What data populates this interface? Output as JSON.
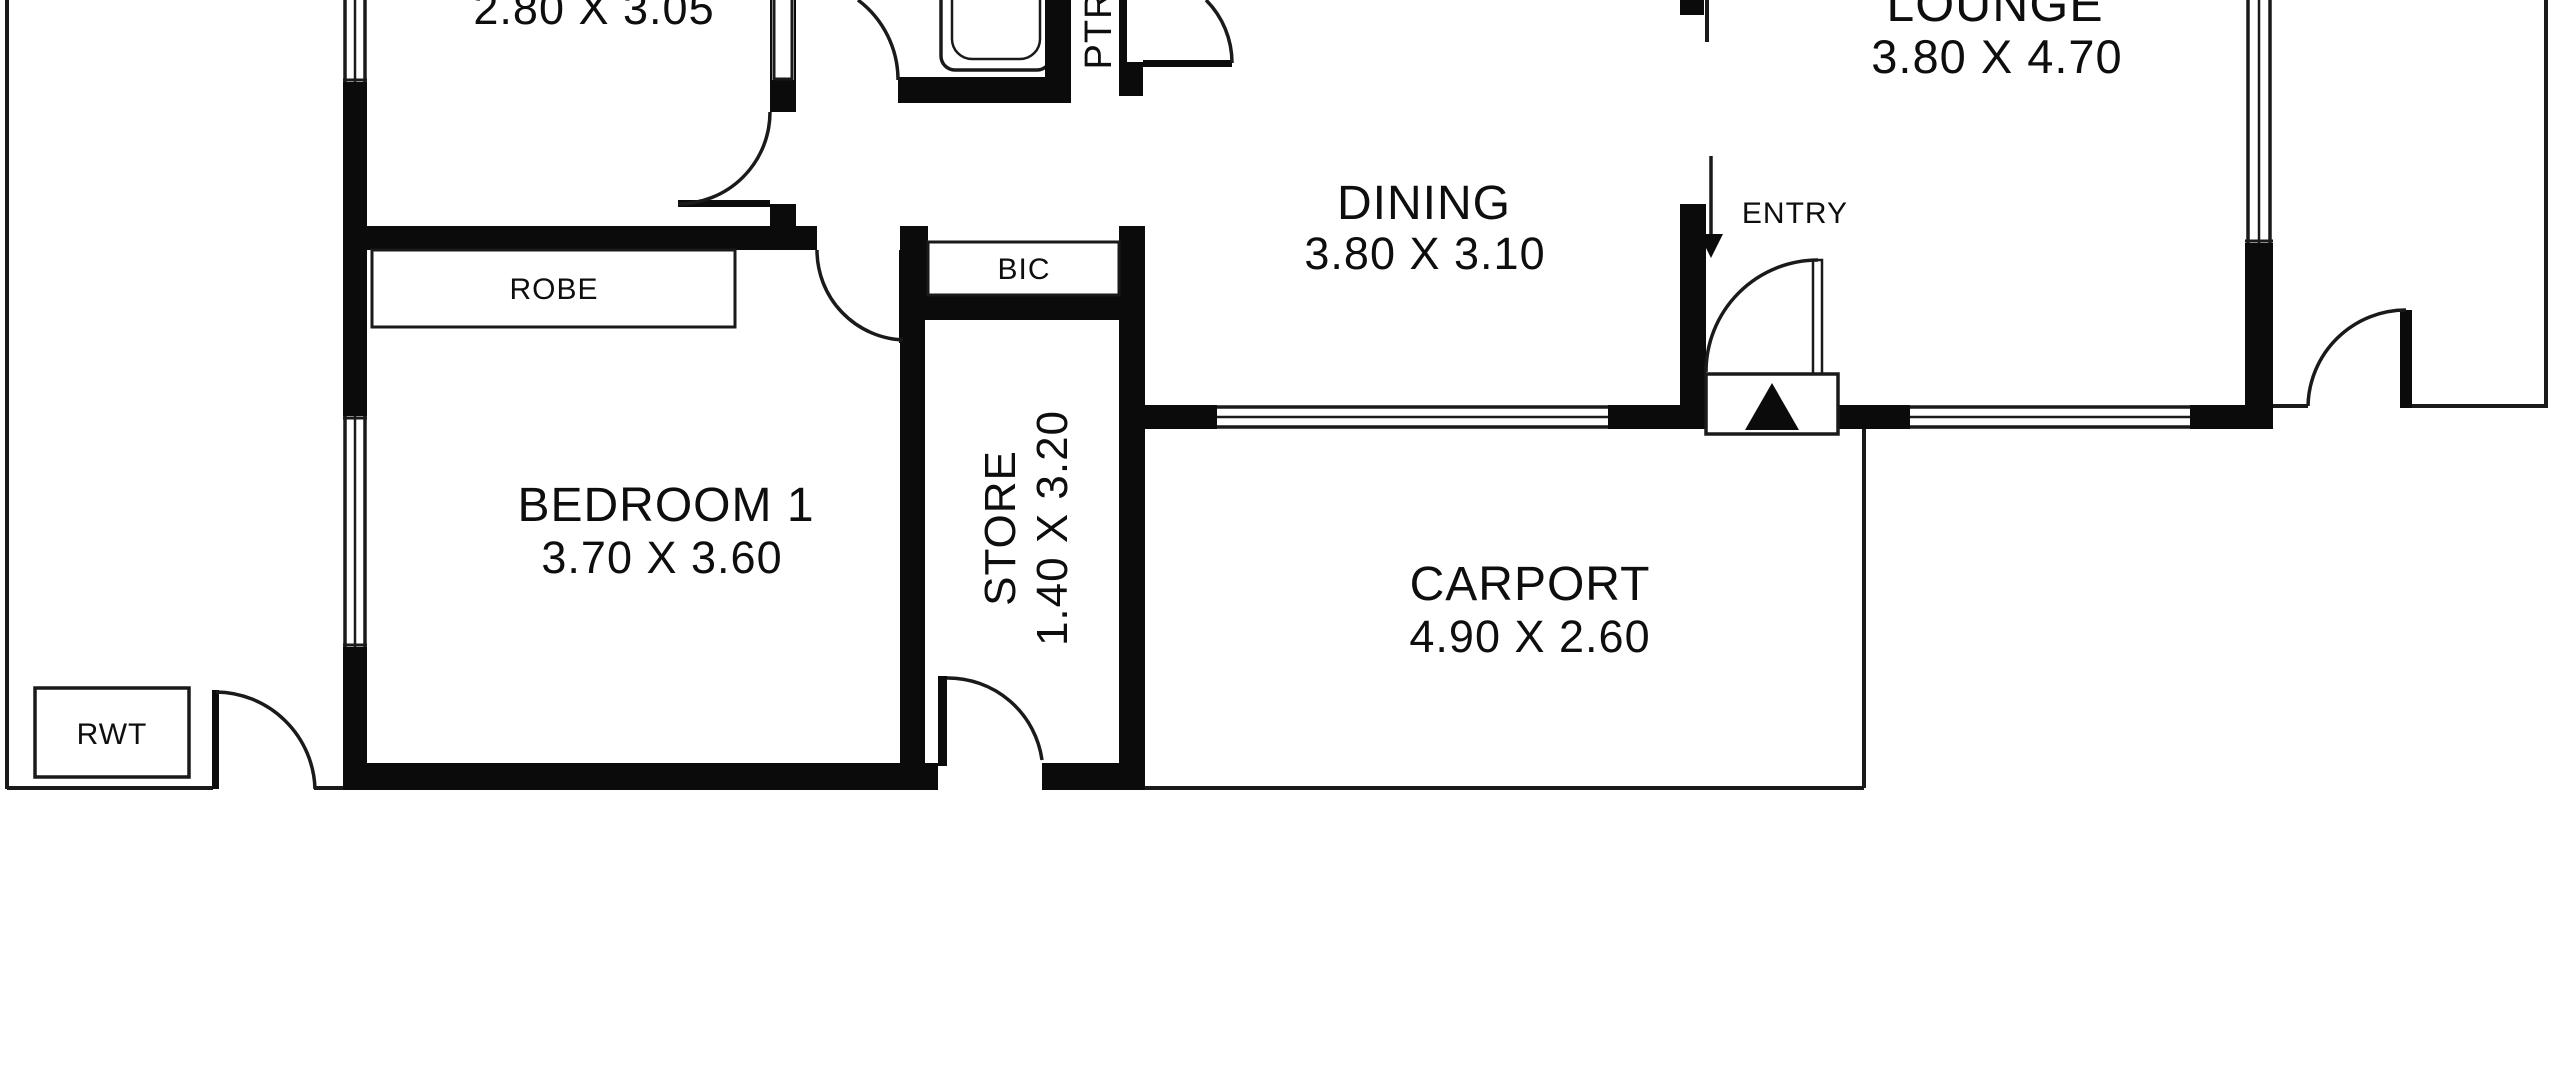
{
  "title": "Floor plan",
  "colors": {
    "background": "#ffffff",
    "wall": "#0b0b0b",
    "thin_line": "#1a1a1a"
  },
  "rooms": {
    "bedroom2": {
      "dims": "2.80 X 3.05"
    },
    "bedroom1": {
      "name": "BEDROOM 1",
      "dims": "3.70 X 3.60"
    },
    "dining": {
      "name": "DINING",
      "dims": "3.80 X 3.10"
    },
    "lounge": {
      "name": "LOUNGE",
      "dims": "3.80 X 4.70"
    },
    "store": {
      "name": "STORE",
      "dims": "1.40 X 3.20"
    },
    "carport": {
      "name": "CARPORT",
      "dims": "4.90 X 2.60"
    }
  },
  "labels": {
    "robe": "ROBE",
    "bic": "BIC",
    "rwt": "RWT",
    "ptr": "PTR",
    "entry": "ENTRY"
  }
}
